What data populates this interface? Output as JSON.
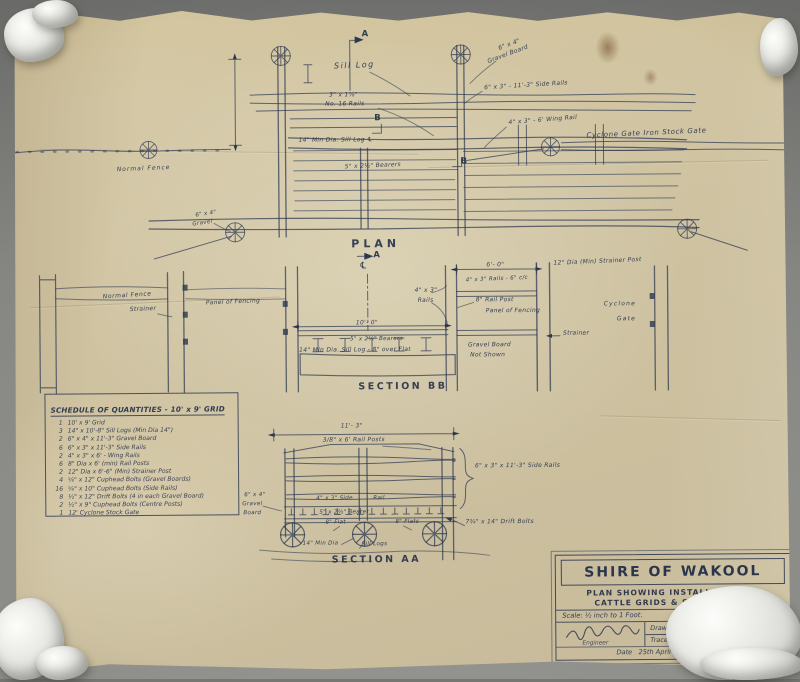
{
  "plan": {
    "title": "PLAN",
    "marker_a": "A",
    "marker_b": "B",
    "sill_log": "Sill Log",
    "grid_rails_1": "3\" x 1⅞\"",
    "grid_rails_2": "No. 16 Rails",
    "gravel_board_1": "6\" x 4\"",
    "gravel_board_2": "Gravel Board",
    "side_rails": "6\" x 3\" - 11'-3\" Side Rails",
    "wing_rail": "4\" x 3\" - 6' Wing Rail",
    "stock_gate": "Cyclone Gate Iron Stock Gate",
    "normal_fence": "Normal Fence",
    "sill_log_dia": "14\" Min Dia. Sill Log ℄",
    "bearers": "5\" x 2½\" Bearers",
    "gravel_small_1": "6\" x 4\"",
    "gravel_small_2": "Gravel"
  },
  "section_bb": {
    "title": "SECTION BB",
    "centerline": "℄",
    "normal_fence": "Normal Fence",
    "strainer_left": "Strainer",
    "panel_of_fencing": "Panel of Fencing",
    "dim_width": "10'- 0\"",
    "bearers": "5\" x 2½\" Bearers",
    "sill_log": "14\" Min Dia. Sill Log - 8\" over Flat",
    "rails_1": "4\" x 3\"",
    "rails_2": "Rails",
    "dim_right": "6'- 0\"",
    "rails_cc": "4\" x 3\" Rails - 6\" c/c",
    "strainer_post": "12\" Dia (Min) Strainer Post",
    "rail_post": "8\" Rail Post",
    "panel_right": "Panel of Fencing",
    "cyclone": "Cyclone",
    "gate": "Gate",
    "strainer_mid": "Strainer",
    "gravel_1": "Gravel Board",
    "gravel_2": "Not Shown"
  },
  "section_aa": {
    "title": "SECTION AA",
    "dim_width": "11'- 3\"",
    "rail_posts": "3/8\" x 6' Rail Posts",
    "side_rails": "6\" x 3\" x 11'-3\" Side Rails",
    "side_rail_1": "4\" x 3\" Side",
    "side_rail_2": "Rail",
    "bearer": "5\" x 2½\" Bearer",
    "flat_1": "8\" Flat",
    "flat_2": "8\" Flats",
    "sill_dia": "14\" Min Dia",
    "sill_logs": "Sill Logs",
    "drift_bolts": "7¾\" x 14\" Drift Bolts",
    "gravel_1": "6\" x 4\"",
    "gravel_2": "Gravel",
    "gravel_3": "Board"
  },
  "schedule": {
    "title": "SCHEDULE OF QUANTITIES - 10' x 9' GRID",
    "items": [
      {
        "qty": "1",
        "desc": "10' x 9' Grid"
      },
      {
        "qty": "3",
        "desc": "14\" x 10'-8\" Sill Logs (Min Dia 14\")"
      },
      {
        "qty": "2",
        "desc": "6\" x 4\" x 11'-3\" Gravel Board"
      },
      {
        "qty": "6",
        "desc": "6\" x 3\" x 11'-3\" Side Rails"
      },
      {
        "qty": "2",
        "desc": "4\" x 3\" x 6' - Wing Rails"
      },
      {
        "qty": "6",
        "desc": "8\" Dia x 6' (min) Rail Posts"
      },
      {
        "qty": "2",
        "desc": "12\" Dia x 6'-6\" (Min) Strainer Post"
      },
      {
        "qty": "4",
        "desc": "⅝\" x 12\" Cuphead Bolts (Gravel Boards)"
      },
      {
        "qty": "16",
        "desc": "⅝\" x 10\" Cuphead Bolts (Side Rails)"
      },
      {
        "qty": "8",
        "desc": "½\" x 12\" Drift Bolts (4 in each Gravel Board)"
      },
      {
        "qty": "2",
        "desc": "½\" x 9\" Cuphead Bolts (Centre Posts)"
      },
      {
        "qty": "1",
        "desc": "12' Cyclone Stock Gate"
      }
    ]
  },
  "title_block": {
    "org": "SHIRE OF WAKOOL",
    "subtitle_1": "PLAN SHOWING INSTALLATION OF",
    "subtitle_2": "CATTLE GRIDS & STOCK GATES",
    "scale": "Scale: ½ inch to 1 Foot.",
    "engineer_label": "Engineer",
    "drawn_label": "Drawn",
    "drawn_value": "N.D.L.",
    "traced_label": "Traced",
    "traced_value": "N.D.L.",
    "date_label": "Date",
    "date_value": "25th April 1960"
  }
}
